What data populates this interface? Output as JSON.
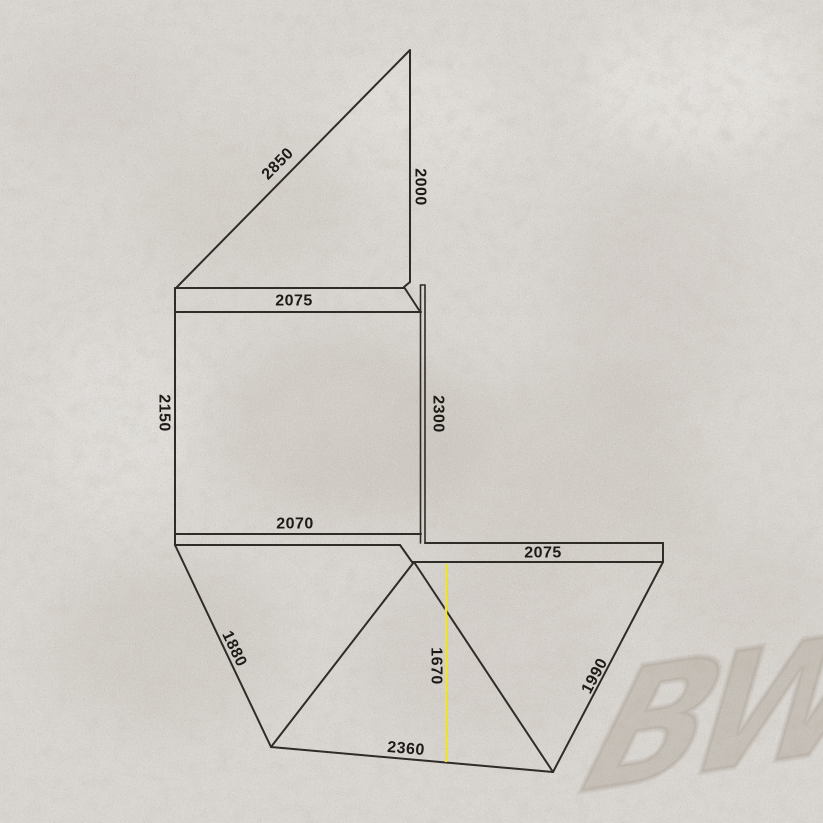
{
  "diagram": {
    "watermark": "BW",
    "labels": {
      "top_panel_diagonal": "2850",
      "top_panel_side": "2000",
      "main_panel_top_width": "2075",
      "main_panel_left_height": "2150",
      "main_panel_right_height": "2300",
      "main_panel_bottom_width": "2070",
      "left_wing_outer_edge": "1880",
      "center_drop_height": "1670",
      "bottom_outer_edge": "2360",
      "right_wing_outer_edge": "1990",
      "right_panel_width": "2075"
    },
    "colors": {
      "background": "#d9d6d2",
      "line": "#2f2b27",
      "text": "#1c1a17",
      "highlight": "#eee335",
      "watermark": "#9a8e7f"
    }
  }
}
